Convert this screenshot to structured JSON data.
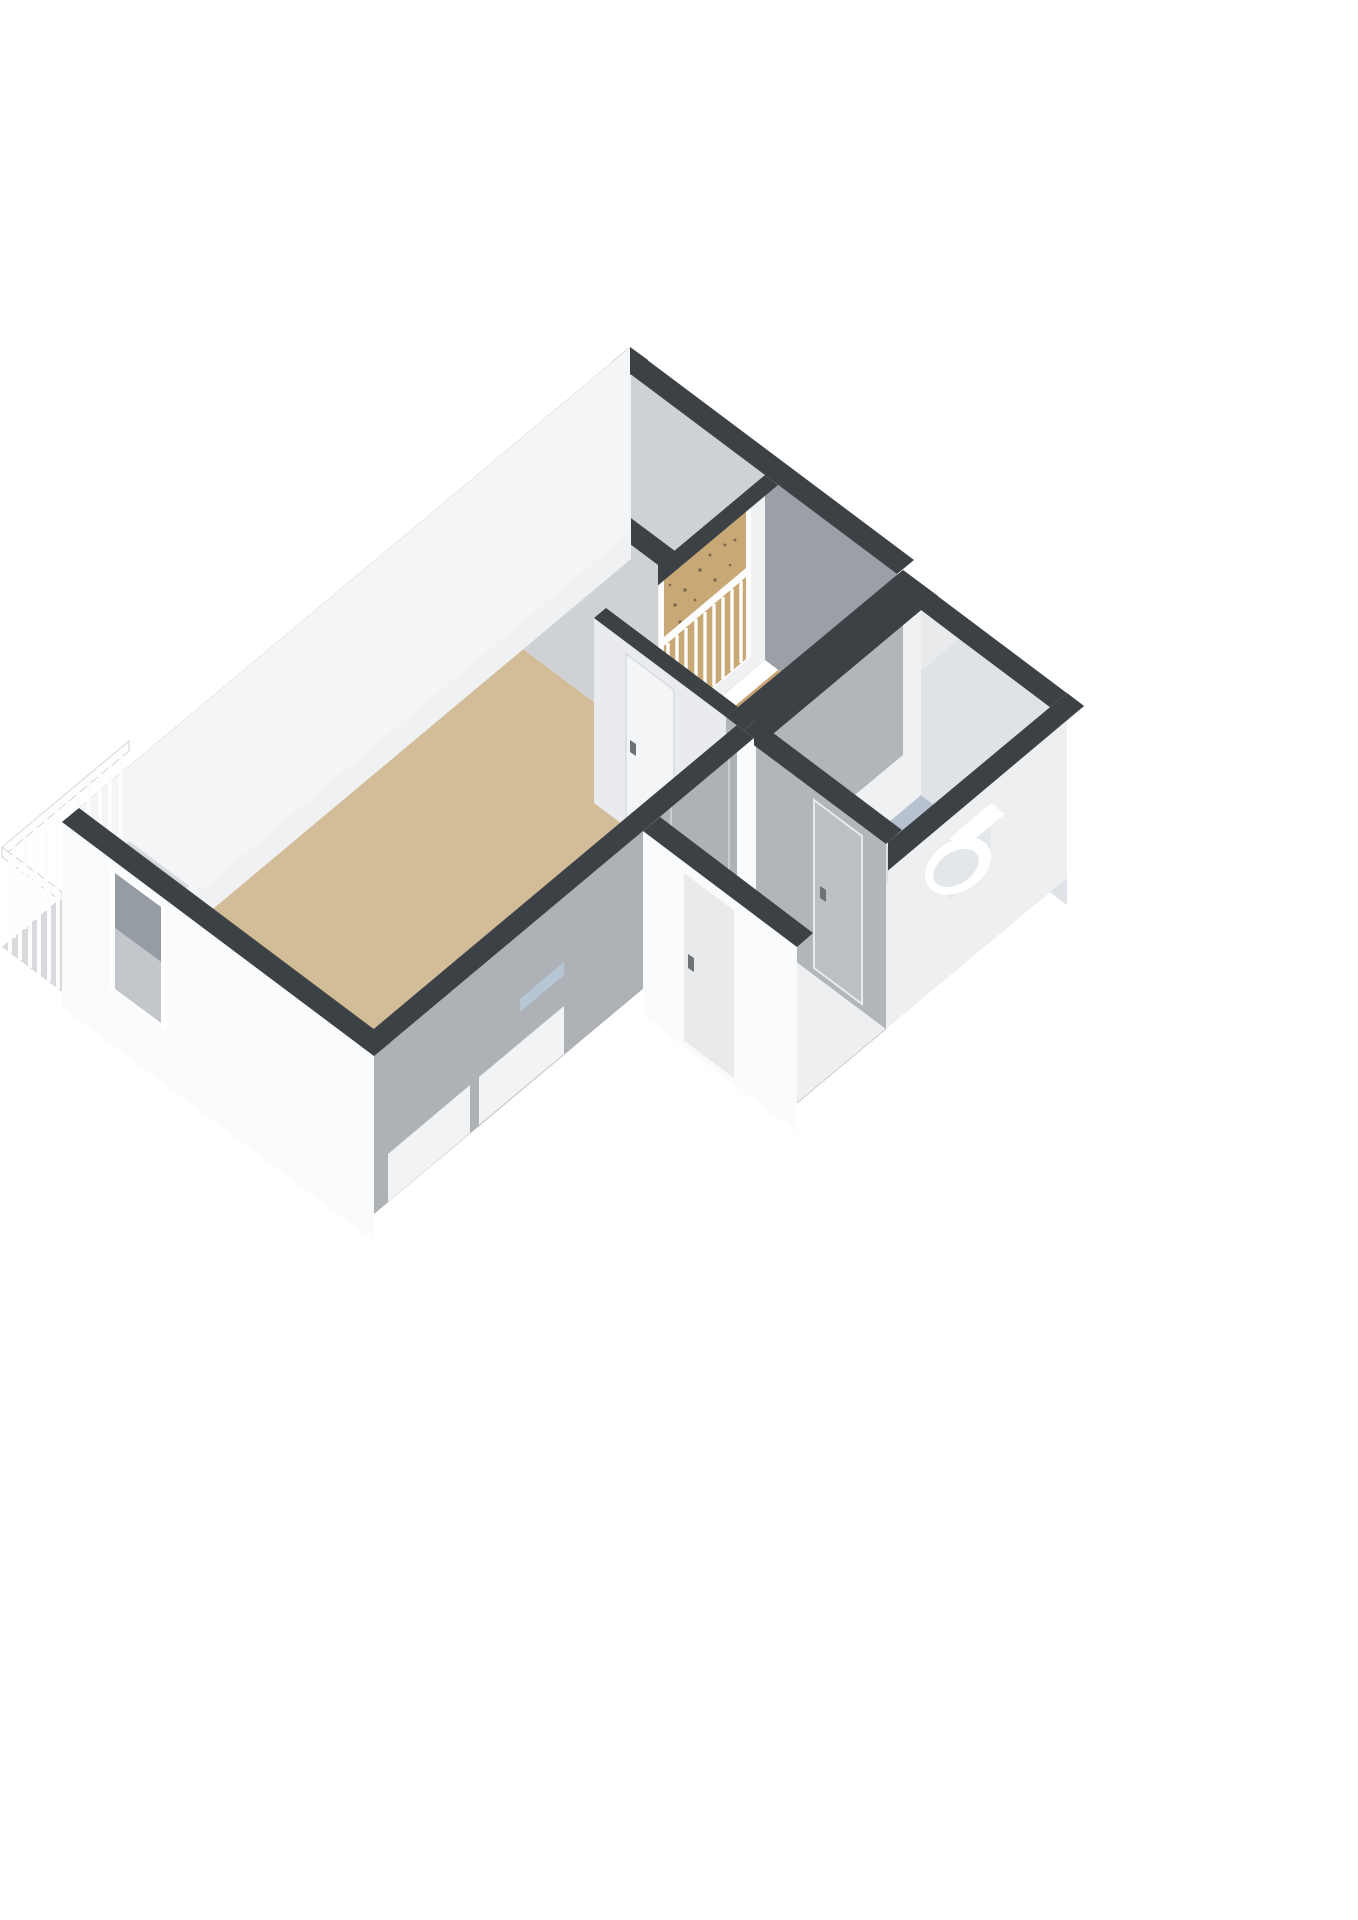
{
  "scene": {
    "kind": "isometric-3d-floorplan-cutaway",
    "background": "#ffffff",
    "rooms": [
      {
        "id": "living-room",
        "floor_material": "wood",
        "floor_color": "#d3bc98"
      },
      {
        "id": "bedroom",
        "floor_material": "wood",
        "floor_color": "#c7a371"
      },
      {
        "id": "bathroom",
        "floor_material": "tile",
        "floor_color": "#b7c1d0",
        "fixtures": [
          "wall-hung-toilet",
          "washbasin",
          "service-duct"
        ]
      },
      {
        "id": "hallway",
        "floor_material": "wood",
        "floor_color": "#c7a371"
      },
      {
        "id": "north-nook",
        "floor_material": "screed",
        "floor_color": "#c4c7cb"
      }
    ],
    "openings": {
      "front_door": 1,
      "interior_doors": 3,
      "balcony_door": 1,
      "windows_with_railing": 3,
      "exterior_windows": 1,
      "low_sill_windows": 3
    },
    "features": [
      "balcony-balustrade",
      "french-balcony-railings",
      "cutaway-walls-dark-tops"
    ],
    "colors": {
      "wall_top": "#3c4146",
      "wall_exterior": "#f4f5f6",
      "wall_exterior_bright": "#fafbfc",
      "wall_interior_white": "#f0f1f3",
      "wall_interior_light": "#e9ebee",
      "wall_gray_light": "#cfd2d5",
      "wall_gray": "#aeb2b7",
      "wall_gray_dark": "#9ba0a6",
      "wall_gray_mid": "#b2b6bb",
      "bath_north": "#dfe2e6",
      "right_east_face": "#edeff1",
      "floor_living": "#d3bc98",
      "floor_bedroom": "#c7a371",
      "floor_bath": "#b7c1d0",
      "floor_nook": "#c4c7cb",
      "balcony_floor": "#d8dadd",
      "glass_dark": "#959ca4",
      "glass_light": "#c3c6ca",
      "glass_blue": "#b9cadb",
      "rail": "#fdfdfd",
      "fixture_white": "#ffffff",
      "fixture_shade": "#e3e7ea",
      "handle": "#6d7277",
      "door_leaf": "#f4f5f6",
      "door_gray": "#bcc0c5",
      "sill": "#f2f3f4",
      "duct_top": "#e8eaec",
      "duct_south": "#dfe2e5",
      "duct_west": "#eff1f3",
      "tan_view": "#c8a875",
      "speckle": "#7c6a4e",
      "tick": "#e8e8e8"
    }
  }
}
